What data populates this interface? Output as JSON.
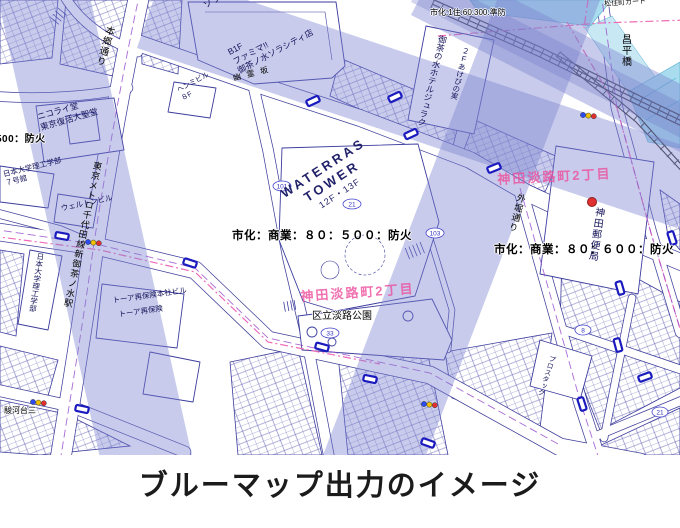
{
  "caption": "ブルーマップ出力のイメージ",
  "map": {
    "zoning": {
      "top": "市化:1住:60:300:準防",
      "left_partial": "500：防火",
      "center": "市化：商業：８０：５００：防火",
      "right": "市化：商業：８０：６００：防火"
    },
    "districts": {
      "kanda_awajicho_ne": "神田淡路町2丁目",
      "kanda_awajicho_sw": "神田淡路町2丁目"
    },
    "streets": {
      "hongo_dori": "本郷通り",
      "sotobori_dori": "外堀通り",
      "metro_station": "東京メトロ千代田線新御茶ノ水駅",
      "shohei_bashi": "昌平橋",
      "matsuzumicho_gado": "松住町ガード",
      "surugadai_3": "駿河台三",
      "yurei_zaka": "幽霊坂"
    },
    "places": {
      "sola_city_l1": "御茶ノ水",
      "sola_city_l2": "ソラシティ",
      "famima_floor": "B1F",
      "famima": "ファミマ!!",
      "famima_store": "御茶ノ水ソラシティ店",
      "waterras_l1": "WATERRAS",
      "waterras_l2": "TOWER",
      "waterras_floors": "12F・13F",
      "nikolai_l1": "ニコライ堂",
      "nikolai_l2": "東京復活大聖堂",
      "nichidai_bldg7_l1": "日本大学理工学部",
      "nichidai_bldg7_l2": "７号館",
      "nichidai_vert": "日本大学理工学部",
      "welton": "ウェルトンビル",
      "henmi_l1": "ヘンミビル",
      "henmi_l2": "８F",
      "juraku": "御茶の水ホテルジュラク",
      "akebi": "２Fあけびの実",
      "awaji_park": "区立淡路公園",
      "kanda_post_office": "神田郵便局",
      "toa_honsha": "トーア再保険本社ビル",
      "toa": "トーア再保険",
      "prostack": "プロスタック"
    },
    "badges": [
      {
        "n": "101"
      },
      {
        "n": "21"
      },
      {
        "n": "103"
      },
      {
        "n": "33"
      },
      {
        "n": "8"
      },
      {
        "n": "21"
      }
    ]
  }
}
